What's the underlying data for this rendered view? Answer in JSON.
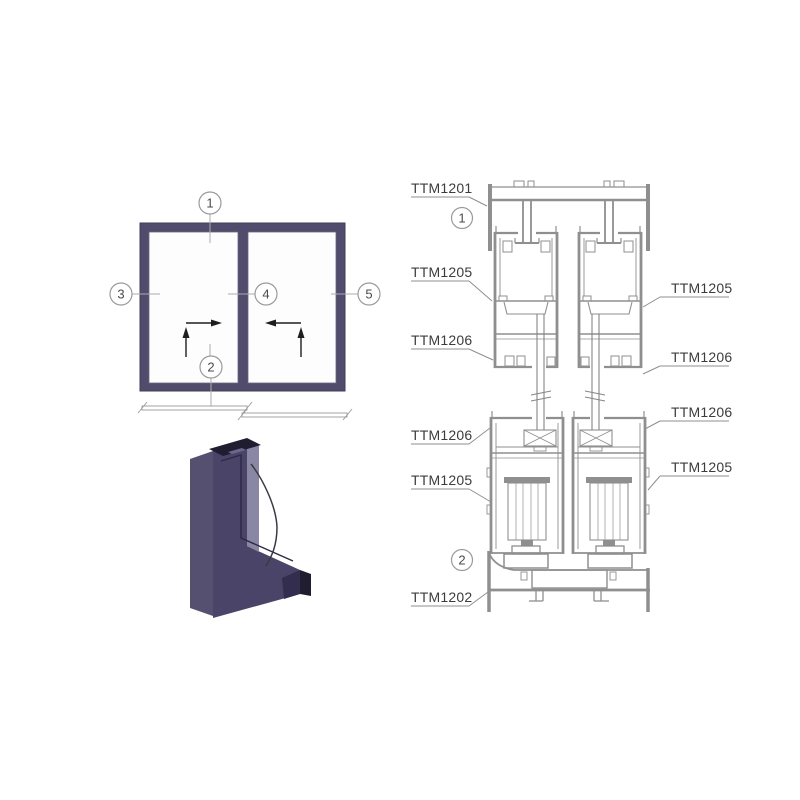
{
  "figure": {
    "kind": "aluminium sliding window profile system technical diagram"
  },
  "colors": {
    "background": "#ffffff",
    "drawing_line": "#8f8f8f",
    "label_text": "#3c3c3c",
    "callout_stroke": "#9a9a9a",
    "frame_purple": "#524c6c",
    "profile_front": "#4a4468",
    "profile_side": "#8a87a5",
    "profile_fin": "#565070",
    "profile_cut": "#211d30",
    "arrow_color": "#1e1e1e"
  },
  "elevation": {
    "callouts": [
      "1",
      "2",
      "3",
      "4",
      "5"
    ]
  },
  "section": {
    "callouts": [
      "1",
      "2"
    ],
    "left_labels": [
      "TTM1201",
      "TTM1205",
      "TTM1206",
      "TTM1206",
      "TTM1205",
      "TTM1202"
    ],
    "right_labels": [
      "TTM1205",
      "TTM1206",
      "TTM1206",
      "TTM1205"
    ]
  }
}
